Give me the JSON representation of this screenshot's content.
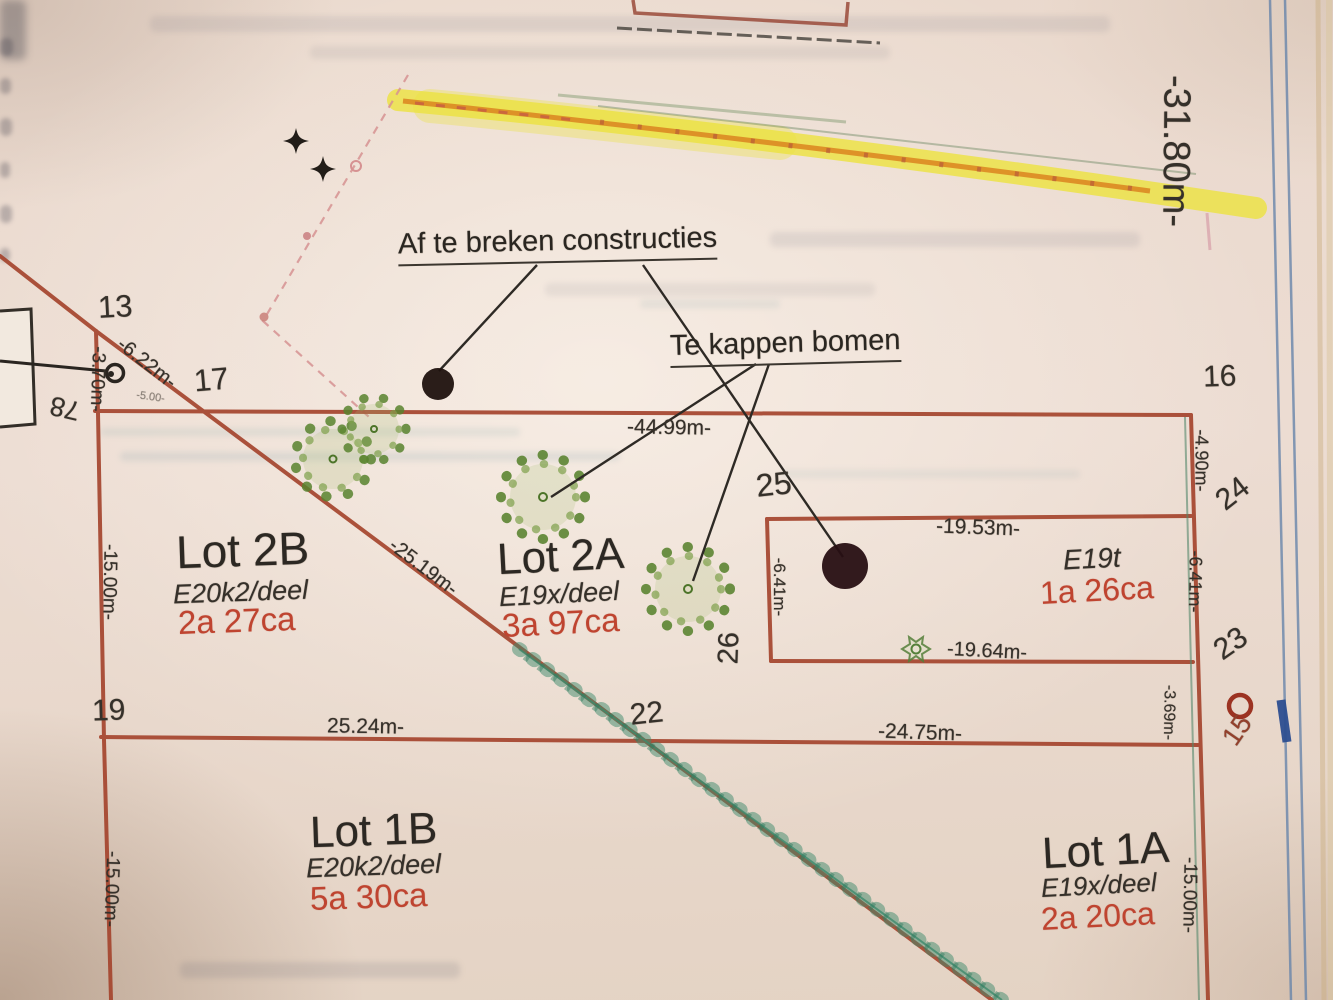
{
  "plan": {
    "annotations": {
      "demolish": "Af te breken constructies",
      "fell_trees": "Te kappen bomen"
    },
    "lots": {
      "lot2b": {
        "name": "Lot 2B",
        "parcel": "E20k2/deel",
        "area": "2a 27ca"
      },
      "lot2a": {
        "name": "Lot 2A",
        "parcel": "E19x/deel",
        "area": "3a 97ca"
      },
      "e19t": {
        "name": "E19t",
        "area": "1a 26ca"
      },
      "lot1b": {
        "name": "Lot 1B",
        "parcel": "E20k2/deel",
        "area": "5a 30ca"
      },
      "lot1a": {
        "name": "Lot 1A",
        "parcel": "E19x/deel",
        "area": "2a 20ca"
      }
    },
    "points": {
      "p13": "13",
      "p15": "15",
      "p16": "16",
      "p17": "17",
      "p19": "19",
      "p22": "22",
      "p23": "23",
      "p24": "24",
      "p25": "25",
      "p26": "26",
      "p78": "78"
    },
    "dimensions": {
      "d31_80": "-31.80m-",
      "d44_99": "-44.99m-",
      "d25_19": "-25.19m-",
      "d25_24": "25.24m-",
      "d24_75": "-24.75m-",
      "d19_53": "-19.53m-",
      "d19_64": "-19.64m-",
      "d15_00_left_upper": "-15.00m-",
      "d15_00_left_lower": "-15.00m-",
      "d15_00_right": "-15.00m-",
      "d6_22": "-6.22m-",
      "d6_41_box": "-6.41m-",
      "d6_41_right": "-6.41m-",
      "d4_90": "-4.90m-",
      "d3_70": "-3.70m-",
      "d3_69": "-3.69m-",
      "d5_00": "-5.00-"
    },
    "colors": {
      "boundary_red": "#a5452e",
      "area_red": "#bf4430",
      "ink": "#35302a",
      "tree_green": "#58822e",
      "chain_green": "#3d8a6c",
      "highlight_yellow": "#ece23f",
      "marker_orange": "#dc8a22",
      "margin_blue": "#6884aa"
    }
  }
}
